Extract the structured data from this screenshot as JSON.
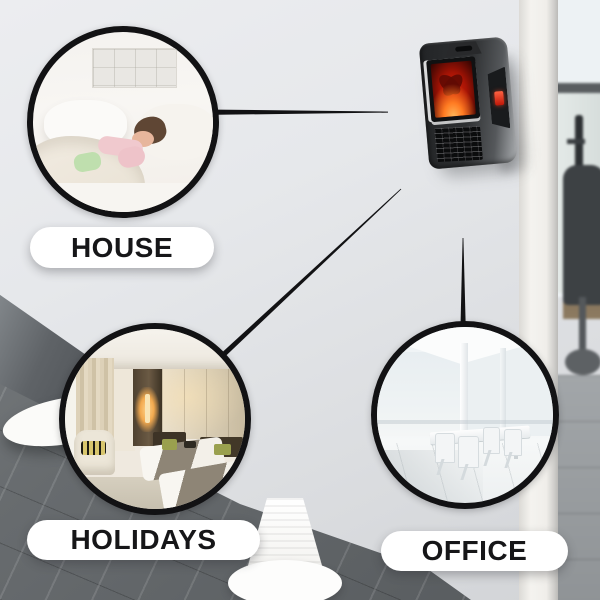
{
  "callouts": [
    {
      "id": "house",
      "label": "HOUSE",
      "photo": "child-sleeping-in-white-bed-photo"
    },
    {
      "id": "holidays",
      "label": "HOLIDAYS",
      "photo": "hotel-twin-bed-room-photo"
    },
    {
      "id": "office",
      "label": "OFFICE",
      "photo": "white-meeting-room-table-chairs-photo"
    }
  ],
  "product_image": "wall-plug-flame-effect-mini-heater",
  "background_image": "office-interior-wall-floor-and-desk-chair",
  "colors": {
    "connector_line": "#121214",
    "circle_ring": "#121214",
    "pill_background": "#ffffff",
    "pill_text": "#161618",
    "wall": "#e3e5e8",
    "floor": "#63676a",
    "heater_body": "#2f3133",
    "heater_flame": "#e8340c",
    "heater_led": "#d42313"
  }
}
